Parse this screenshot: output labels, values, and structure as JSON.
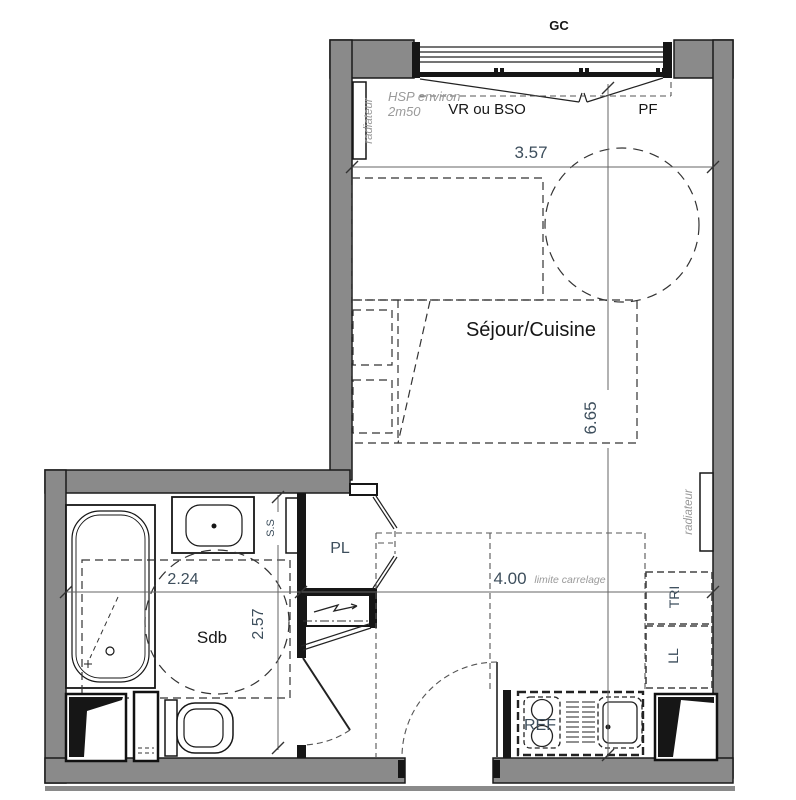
{
  "plan": {
    "title": "studio apartment floor plan",
    "labels": {
      "guardrail": "GC",
      "shutter": "VR ou BSO",
      "fixed_window": "PF",
      "ceiling_height_line1": "HSP environ",
      "ceiling_height_line2": "2m50",
      "radiator_left": "radiateur",
      "radiator_right": "radiateur",
      "towel_rail": "S.S",
      "living_kitchen": "Séjour/Cuisine",
      "bathroom": "Sdb",
      "closet": "PL",
      "sorting_bin": "TRI",
      "washing_machine": "LL",
      "fridge": "REF",
      "tile_limit": "limite carrelage"
    },
    "dimensions": {
      "living_width_m": "3.57",
      "living_depth_m": "6.65",
      "bathroom_width_m": "2.24",
      "bathroom_depth_m": "2.57",
      "lower_width_m": "4.00"
    },
    "colors": {
      "wall": "#8a8a8a",
      "line": "#1a1a1a",
      "dim_text": "#3d4e5c",
      "annotation": "#9a9a9a",
      "background": "#ffffff"
    }
  }
}
